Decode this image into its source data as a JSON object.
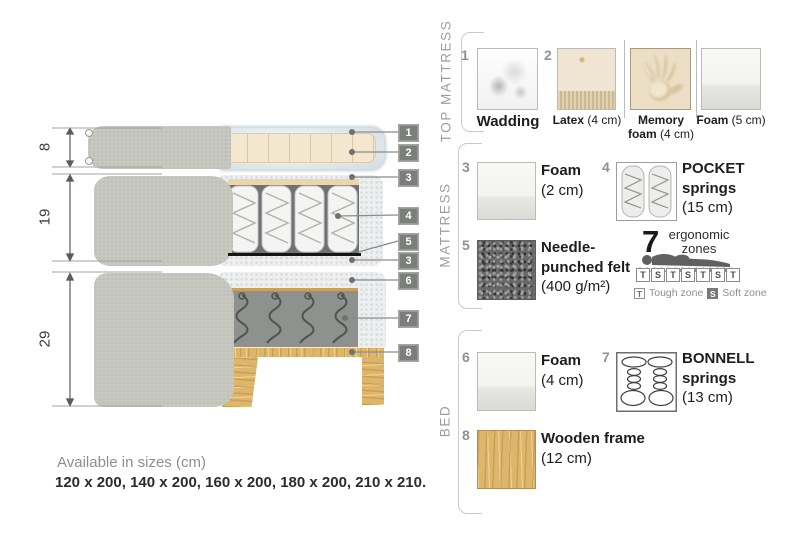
{
  "diagram": {
    "dims": [
      {
        "value": "8"
      },
      {
        "value": "19"
      },
      {
        "value": "29"
      }
    ],
    "callouts": [
      {
        "num": "1"
      },
      {
        "num": "2"
      },
      {
        "num": "3"
      },
      {
        "num": "4"
      },
      {
        "num": "5"
      },
      {
        "num": "3"
      },
      {
        "num": "6"
      },
      {
        "num": "7"
      },
      {
        "num": "8"
      }
    ]
  },
  "legend": {
    "sections": [
      {
        "label": "TOP MATTRESS"
      },
      {
        "label": "MATTRESS"
      },
      {
        "label": "BED"
      }
    ],
    "top_mattress": {
      "items": [
        {
          "num": "1",
          "name": "Wadding",
          "size": ""
        },
        {
          "num": "2",
          "name": "Latex",
          "size": "(4 cm)"
        },
        {
          "num": "",
          "name": "Memory foam",
          "size": "(4 cm)"
        },
        {
          "num": "",
          "name": "Foam",
          "size": "(5 cm)"
        }
      ]
    },
    "mattress": {
      "items": [
        {
          "num": "3",
          "name": "Foam",
          "size": "(2 cm)"
        },
        {
          "num": "4",
          "name": "POCKET springs",
          "size": "(15 cm)"
        },
        {
          "num": "5",
          "name": "Needle-punched felt",
          "size": "(400 g/m²)"
        }
      ],
      "ergonomic": {
        "count": "7",
        "label": "ergonomic zones",
        "zones": [
          "T",
          "S",
          "T",
          "S",
          "T",
          "S",
          "T"
        ],
        "tough_key": "T",
        "tough_label": "Tough zone",
        "soft_key": "S",
        "soft_label": "Soft zone"
      }
    },
    "bed": {
      "items": [
        {
          "num": "6",
          "name": "Foam",
          "size": "(4 cm)"
        },
        {
          "num": "7",
          "name": "BONNELL springs",
          "size": "(13 cm)"
        },
        {
          "num": "8",
          "name": "Wooden frame",
          "size": "(12 cm)"
        }
      ]
    }
  },
  "footer": {
    "title": "Available in sizes (cm)",
    "sizes": "120 x 200, 140 x 200, 160 x 200, 180 x 200, 210 x 210."
  }
}
